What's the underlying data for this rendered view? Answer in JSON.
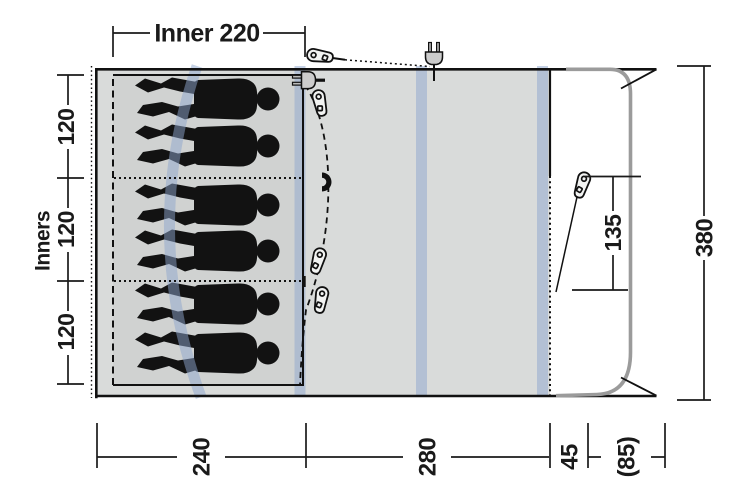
{
  "floorplan": {
    "labels": {
      "inner_width": "Inner 220",
      "inners": "Inners"
    },
    "dimensions": {
      "left_sections": [
        "120",
        "120",
        "120"
      ],
      "bottom_sections": [
        "240",
        "280",
        "45",
        "(85)"
      ],
      "door_width": "135",
      "total_depth": "380"
    },
    "figures": {
      "count": 6,
      "kind": "sleeping-person-silhouette"
    },
    "icons": {
      "top_plug": "power-plug-icon",
      "inner_plug": "power-plug-icon",
      "magnet": "magnet-door-tieback-icon",
      "guyline_pegs": "guyline-runner-peg-icon",
      "peg_count": 5
    },
    "colors": {
      "background": "#ffffff",
      "floor": "#d9dbda",
      "inner_floor": "#d0d2d1",
      "pole_band": "#8ea5cd",
      "door_outline": "#9b9b9b",
      "line": "#1a1a1a",
      "silhouette": "#121212"
    }
  }
}
